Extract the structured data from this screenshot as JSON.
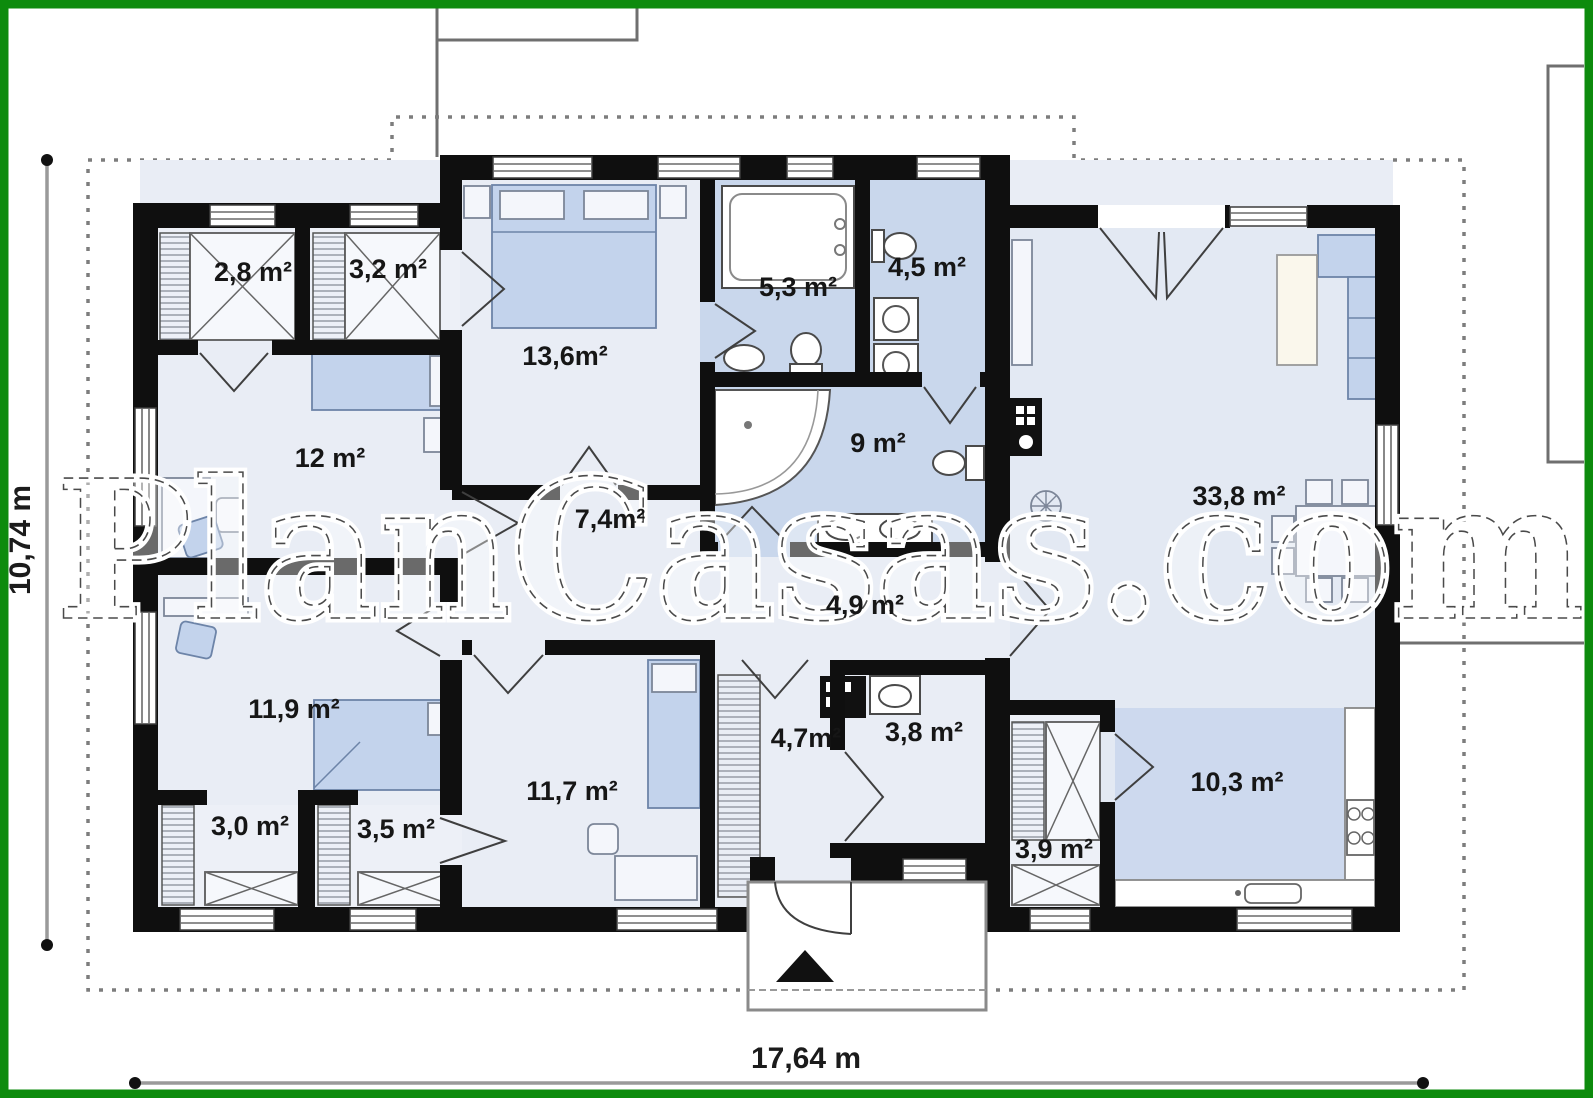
{
  "frame": {
    "color": "#0d8b0d"
  },
  "watermark": {
    "text": "PlanCasas.com"
  },
  "plan": {
    "dimensions": {
      "width_label": "17,64 m",
      "height_label": "10,74 m"
    },
    "rooms": [
      {
        "name": "closet-2-8",
        "label": "2,8 m²"
      },
      {
        "name": "closet-3-2",
        "label": "3,2 m²"
      },
      {
        "name": "bedroom-13-6",
        "label": "13,6m²"
      },
      {
        "name": "bathroom-5-3",
        "label": "5,3 m²"
      },
      {
        "name": "utility-4-5",
        "label": "4,5 m²"
      },
      {
        "name": "room-12",
        "label": "12 m²"
      },
      {
        "name": "bathroom-9",
        "label": "9 m²"
      },
      {
        "name": "hall-7-4",
        "label": "7,4m²"
      },
      {
        "name": "living-33-8",
        "label": "33,8 m²"
      },
      {
        "name": "corridor-4-9",
        "label": "4,9 m²"
      },
      {
        "name": "bedroom-11-9",
        "label": "11,9 m²"
      },
      {
        "name": "bedroom-11-7",
        "label": "11,7 m²"
      },
      {
        "name": "entry-4-7",
        "label": "4,7m²"
      },
      {
        "name": "wc-3-8",
        "label": "3,8 m²"
      },
      {
        "name": "closet-3-0",
        "label": "3,0 m²"
      },
      {
        "name": "closet-3-5",
        "label": "3,5 m²"
      },
      {
        "name": "pantry-3-9",
        "label": "3,9 m²"
      },
      {
        "name": "kitchen-10-3",
        "label": "10,3 m²"
      }
    ]
  }
}
